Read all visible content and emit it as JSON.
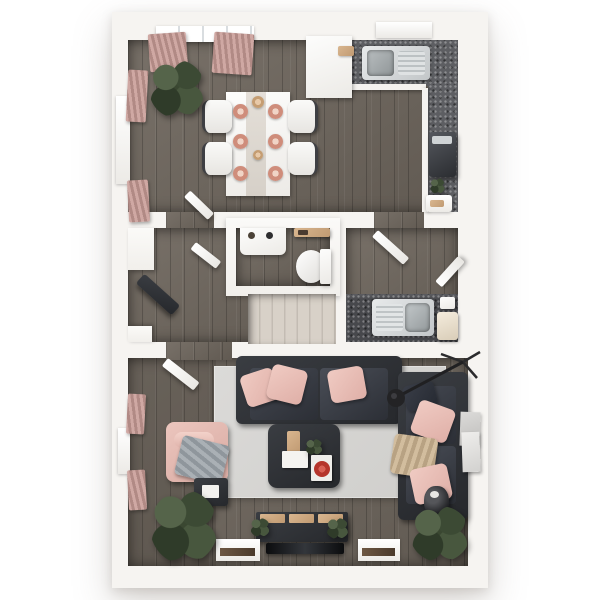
{
  "scene": {
    "type": "3d-floor-plan-top-down-render",
    "style": "photorealistic dollhouse view, no text labels",
    "background_color": "#ffffff",
    "wall_color": "#f6f4f1",
    "wood_floor_color": "#6e665d",
    "rug_color": "#d5d3d1",
    "accent_pink": "#e7c0b8",
    "sofa_charcoal": "#33363e",
    "counter_speckle_gray": "#5d5e62",
    "stair_carpet_beige": "#d2cbc2",
    "plant_green": "#3c4a34",
    "red_accent": "#c23b32"
  },
  "rooms": [
    {
      "name": "kitchen-dining-room",
      "position": "top-section",
      "features": [
        "dark-wood-plank-floor",
        "window-with-pink-curtains-top-wall",
        "kitchen-window-above-sink",
        "radiator-left-wall",
        "pink-curtains-left-wall"
      ],
      "furniture": [
        "white-dining-table-with-runner",
        "six-terracotta-place-settings",
        "four-dining-chairs",
        "large-corner-plant",
        "white-peninsula-unit",
        "l-shaped-speckled-counter",
        "stainless-sink-with-drainer",
        "oven-on-right-counter",
        "small-plant",
        "chopping-board",
        "open-door-to-hallway"
      ]
    },
    {
      "name": "hallway",
      "position": "middle-left",
      "features": [
        "dark-wood-floor",
        "recessed-walls"
      ],
      "furniture": [
        "dark-console-bench-angled",
        "open-door"
      ]
    },
    {
      "name": "wc-cloakroom",
      "position": "middle-center",
      "features": [
        "enclosed-white-walls",
        "dark-wood-floor"
      ],
      "furniture": [
        "white-washbasin-with-accessories",
        "wooden-wall-shelf",
        "toilet"
      ]
    },
    {
      "name": "staircase",
      "position": "middle-center-below-wc",
      "features": [
        "beige-carpeted-steps"
      ]
    },
    {
      "name": "utility-room",
      "position": "middle-right",
      "features": [
        "dark-wood-floor"
      ],
      "furniture": [
        "dark-speckled-counter",
        "stainless-sink-with-drainer",
        "small-white-appliances",
        "two-open-doors"
      ]
    },
    {
      "name": "living-room",
      "position": "bottom-section",
      "features": [
        "dark-wood-floor",
        "large-light-gray-rug",
        "two-pink-curtained-windows-left-wall",
        "two-windows-bottom-wall",
        "wall-art-right-wall"
      ],
      "furniture": [
        "charcoal-three-seat-sofa-with-pink-pillows",
        "charcoal-sofa-right-with-pink-pillows-and-tan-throw",
        "pink-armchair-with-gray-throw",
        "dark-side-table-with-magazine",
        "square-dark-coffee-table",
        "tray-books-plant-red-bowl-on-table",
        "arc-floor-lamp",
        "tv-media-console-with-plants",
        "flat-tv",
        "floor-vase",
        "two-large-plants"
      ]
    }
  ]
}
